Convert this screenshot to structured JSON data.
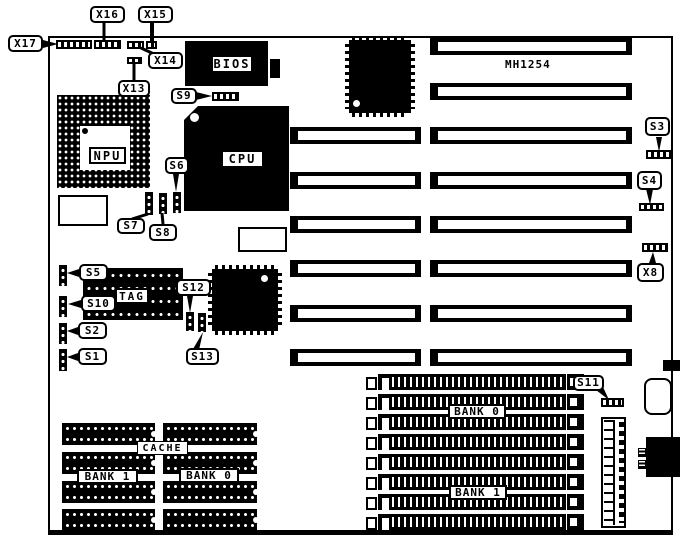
{
  "board": {
    "model": "MH1254"
  },
  "chip_labels": {
    "npu": "NPU",
    "cpu": "CPU",
    "bios": "BIOS",
    "tag": "TAG",
    "cache": "CACHE",
    "cache_bank_left": "BANK 1",
    "cache_bank_right": "BANK 0",
    "simm_bank_top": "BANK 0",
    "simm_bank_bottom": "BANK 1"
  },
  "callouts": {
    "x17": "X17",
    "x16": "X16",
    "x15": "X15",
    "x14": "X14",
    "x13": "X13",
    "x8": "X8",
    "s1": "S1",
    "s2": "S2",
    "s3": "S3",
    "s4": "S4",
    "s5": "S5",
    "s6": "S6",
    "s7": "S7",
    "s8": "S8",
    "s9": "S9",
    "s10": "S10",
    "s11": "S11",
    "s12": "S12",
    "s13": "S13"
  }
}
